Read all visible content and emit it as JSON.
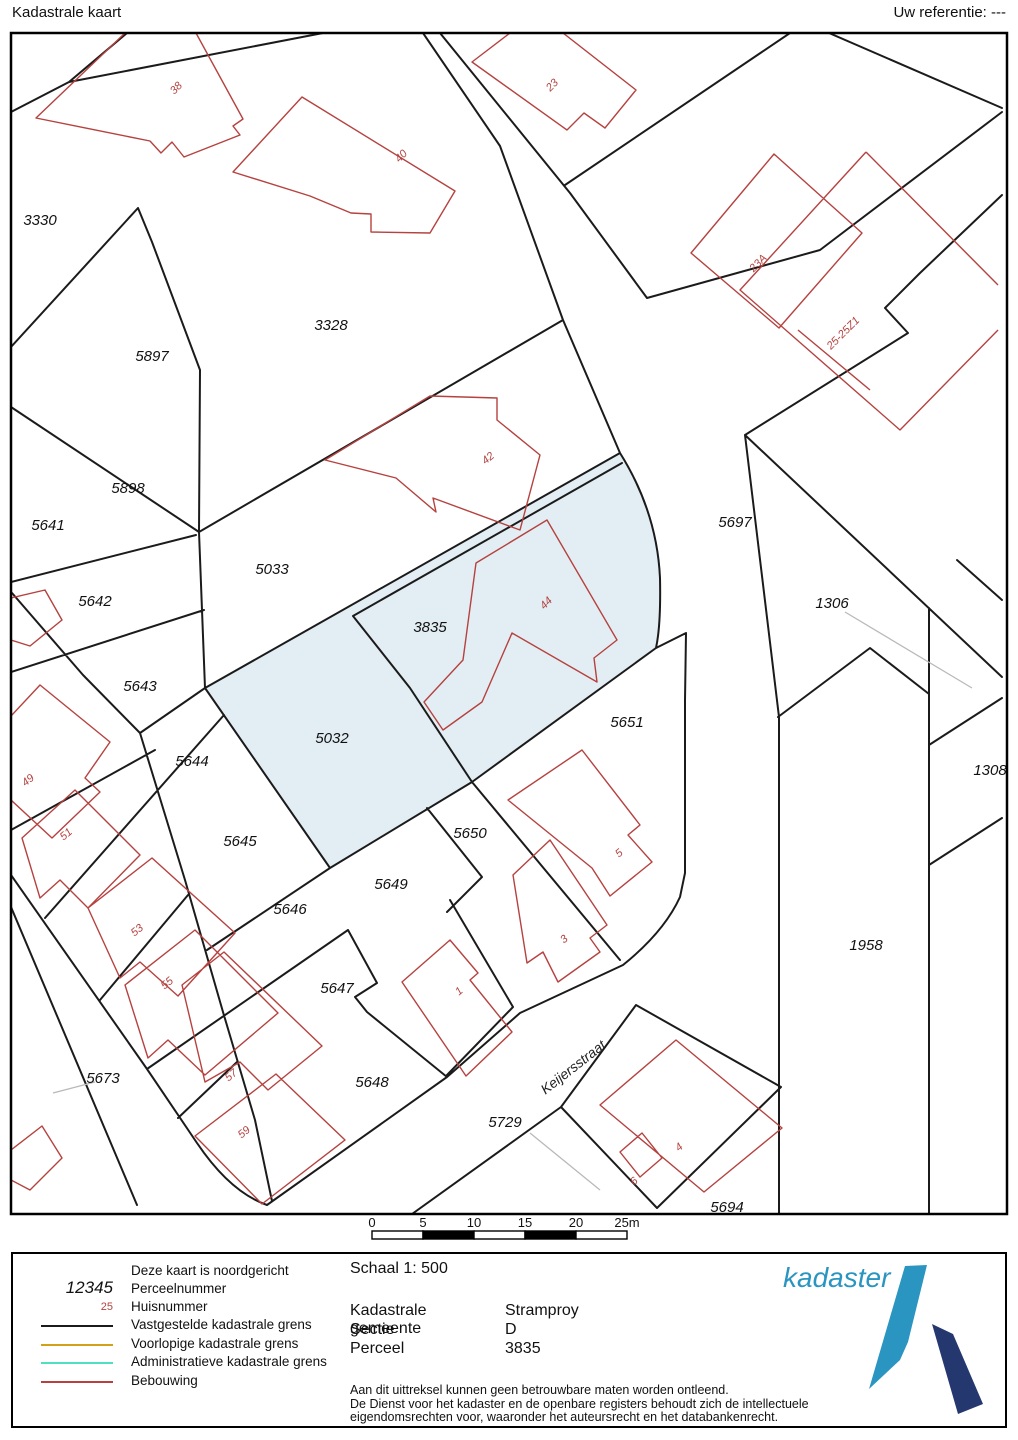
{
  "header": {
    "title": "Kadastrale kaart",
    "reference": "Uw referentie: ---"
  },
  "map": {
    "highlight_color": "#e3eef4",
    "boundary_color": "#1b1b1b",
    "building_color": "#b5423f",
    "parcel_labels": [
      {
        "t": "3330",
        "x": 40,
        "y": 220
      },
      {
        "t": "5897",
        "x": 152,
        "y": 356
      },
      {
        "t": "3328",
        "x": 331,
        "y": 325
      },
      {
        "t": "5898",
        "x": 128,
        "y": 488
      },
      {
        "t": "5641",
        "x": 48,
        "y": 525
      },
      {
        "t": "5642",
        "x": 95,
        "y": 601
      },
      {
        "t": "5643",
        "x": 140,
        "y": 686
      },
      {
        "t": "5644",
        "x": 192,
        "y": 761
      },
      {
        "t": "5645",
        "x": 240,
        "y": 841
      },
      {
        "t": "5646",
        "x": 290,
        "y": 909
      },
      {
        "t": "5647",
        "x": 337,
        "y": 988
      },
      {
        "t": "5648",
        "x": 372,
        "y": 1082
      },
      {
        "t": "5673",
        "x": 103,
        "y": 1078
      },
      {
        "t": "5033",
        "x": 272,
        "y": 569
      },
      {
        "t": "5032",
        "x": 332,
        "y": 738
      },
      {
        "t": "3835",
        "x": 430,
        "y": 627
      },
      {
        "t": "5697",
        "x": 735,
        "y": 522
      },
      {
        "t": "1306",
        "x": 832,
        "y": 603
      },
      {
        "t": "1308",
        "x": 990,
        "y": 770
      },
      {
        "t": "1958",
        "x": 866,
        "y": 945
      },
      {
        "t": "5651",
        "x": 627,
        "y": 722
      },
      {
        "t": "5650",
        "x": 470,
        "y": 833
      },
      {
        "t": "5649",
        "x": 391,
        "y": 884
      },
      {
        "t": "5729",
        "x": 505,
        "y": 1122
      },
      {
        "t": "5694",
        "x": 727,
        "y": 1207
      }
    ],
    "house_numbers": [
      {
        "t": "38",
        "x": 175,
        "y": 87,
        "r": -45
      },
      {
        "t": "40",
        "x": 400,
        "y": 155,
        "r": -45
      },
      {
        "t": "23",
        "x": 551,
        "y": 84,
        "r": -45
      },
      {
        "t": "23A",
        "x": 757,
        "y": 262,
        "r": -45
      },
      {
        "t": "25-25Z1",
        "x": 842,
        "y": 332,
        "r": -45
      },
      {
        "t": "42",
        "x": 487,
        "y": 457,
        "r": -40
      },
      {
        "t": "44",
        "x": 545,
        "y": 602,
        "r": -45
      },
      {
        "t": "49",
        "x": 27,
        "y": 779,
        "r": -40
      },
      {
        "t": "51",
        "x": 65,
        "y": 833,
        "r": -40
      },
      {
        "t": "53",
        "x": 136,
        "y": 929,
        "r": -40
      },
      {
        "t": "55",
        "x": 166,
        "y": 982,
        "r": -40
      },
      {
        "t": "57",
        "x": 230,
        "y": 1074,
        "r": -40
      },
      {
        "t": "59",
        "x": 243,
        "y": 1131,
        "r": -40
      },
      {
        "t": "1",
        "x": 458,
        "y": 990,
        "r": -40
      },
      {
        "t": "3",
        "x": 563,
        "y": 938,
        "r": -40
      },
      {
        "t": "5",
        "x": 618,
        "y": 852,
        "r": -40
      },
      {
        "t": "4",
        "x": 678,
        "y": 1146,
        "r": -40
      },
      {
        "t": "6",
        "x": 633,
        "y": 1180,
        "r": -40
      }
    ],
    "street_labels": [
      {
        "t": "Keijersstraat",
        "x": 573,
        "y": 1067,
        "r": -38
      }
    ]
  },
  "scalebar": {
    "ticks": [
      "0",
      "5",
      "10",
      "15",
      "20",
      "25m"
    ]
  },
  "legend": {
    "north_note": "Deze kaart is noordgericht",
    "perceel_sample": "12345",
    "perceel_label": "Perceelnummer",
    "huis_sample": "25",
    "huis_label": "Huisnummer",
    "lines": [
      {
        "label": "Vastgestelde kadastrale grens",
        "color": "#1b1b1b"
      },
      {
        "label": "Voorlopige kadastrale grens",
        "color": "#d4a017"
      },
      {
        "label": "Administratieve kadastrale grens",
        "color": "#4fe0c2"
      },
      {
        "label": "Bebouwing",
        "color": "#b5423f"
      }
    ]
  },
  "details": {
    "schaal": "Schaal 1: 500",
    "rows": [
      {
        "label": "Kadastrale gemeente",
        "value": "Stramproy"
      },
      {
        "label": "Sectie",
        "value": "D"
      },
      {
        "label": "Perceel",
        "value": "3835"
      }
    ]
  },
  "disclaimer": [
    "Aan dit uittreksel kunnen geen betrouwbare maten worden ontleend.",
    "De Dienst voor het kadaster en de openbare registers behoudt zich de intellectuele",
    "eigendomsrechten voor, waaronder het auteursrecht en het databankenrecht."
  ],
  "logo": {
    "text": "kadaster"
  }
}
